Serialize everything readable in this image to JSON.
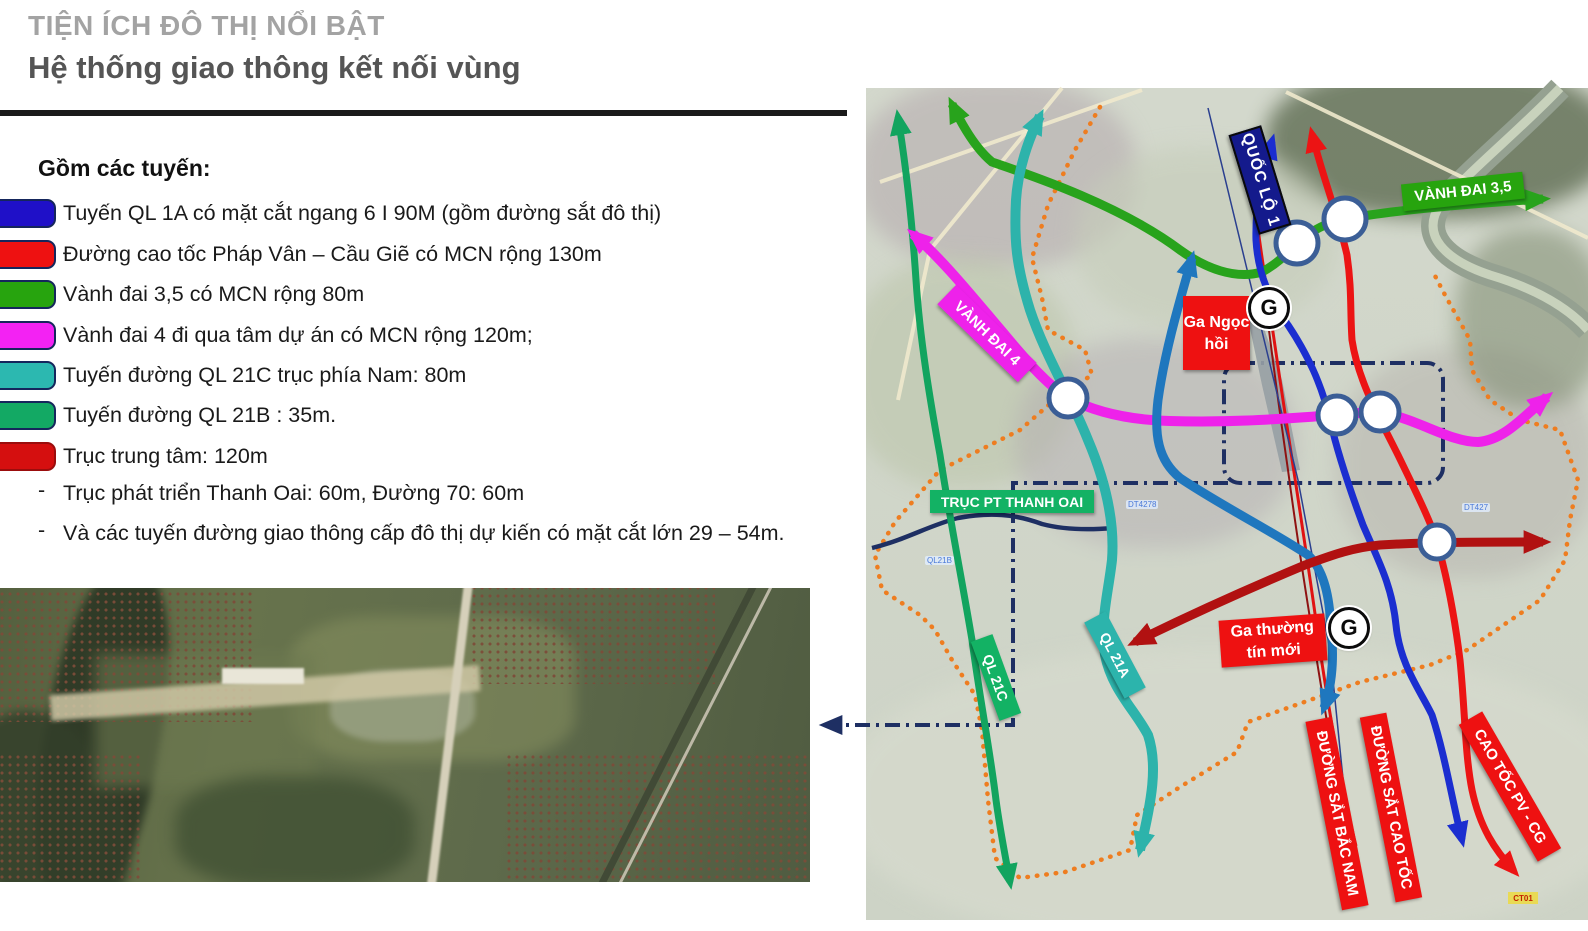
{
  "slide": {
    "title_small": "TIỆN ÍCH ĐÔ THỊ NỔI BẬT",
    "title_main": "Hệ thống giao thông kết nối vùng"
  },
  "legend": {
    "heading": "Gồm các tuyến:",
    "dash": "-",
    "items": [
      {
        "color": "#1f10c8",
        "text": "Tuyến QL 1A có mặt cắt ngang 6 I 90M (gồm đường sắt đô thị)"
      },
      {
        "color": "#ee1111",
        "text": "Đường cao tốc Pháp Vân – Cầu Giẽ có MCN rộng 130m"
      },
      {
        "color": "#27a40e",
        "text": "Vành đai 3,5 có MCN rộng 80m"
      },
      {
        "color": "#f322f3",
        "text": "Vành đai 4 đi qua tâm dự án có MCN rộng 120m;"
      },
      {
        "color": "#2cb8b0",
        "text": "Tuyến đường QL 21C trục phía Nam: 80m"
      },
      {
        "color": "#13a964",
        "text": "Tuyến đường QL 21B : 35m."
      },
      {
        "color": "#d50f0f",
        "text": "Trục trung tâm: 120m"
      }
    ],
    "notes": [
      "Trục phát triển Thanh Oai: 60m, Đường 70: 60m",
      "Và các tuyến đường giao thông cấp đô thị dự kiến có mặt cắt lớn 29 – 54m."
    ]
  },
  "map": {
    "labels": {
      "quoc_lo_1": "QUỐC LỘ 1",
      "vanh_dai_35": "VÀNH ĐAI 3,5",
      "vanh_dai_4": "VÀNH ĐAI 4",
      "truc_pt_thanh_oai": "TRỤC PT THANH OAI",
      "ql_21c": "QL 21C",
      "ql_21a": "QL 21A",
      "ga_ngoc_hoi": "Ga Ngọc hồi",
      "ga_thuong_tin_moi": "Ga thường tín mới",
      "duong_sat_bac_nam": "ĐƯỜNG SẮT BẮC NAM",
      "duong_sat_cao_toc": "ĐƯỜNG SẮT CAO TỐC",
      "cao_toc_pv_cg": "CAO TỐC PV - CG",
      "g_station": "G",
      "ct01": "CT01",
      "dt4278": "DT4278",
      "dt427": "DT427",
      "ql21b_small": "QL21B"
    },
    "colors": {
      "green": "#28a31c",
      "emerald": "#12a45f",
      "teal": "#2db3ab",
      "magenta": "#ee22ea",
      "blue": "#1b2ed0",
      "red": "#ec1414",
      "dark_red": "#b11111",
      "steel_blue": "#1f77be",
      "navy": "#1e2f63",
      "orange": "#ee7d20",
      "node_ring": "#3b5e96",
      "rail_red": "#e01212",
      "rail_maroon": "#8e1212",
      "rail_blue": "#2a3f8f",
      "river": "#95a191",
      "river_center": "#c8d2bc",
      "pale_road": "#efe9cd",
      "label_red": "#ee1111",
      "label_navy": "#141a8c",
      "label_green": "#27a40e",
      "label_emerald": "#13b264",
      "label_teal": "#2cb4ac",
      "label_magenta": "#ee22ea",
      "ct01_bg": "#e9da55"
    }
  }
}
